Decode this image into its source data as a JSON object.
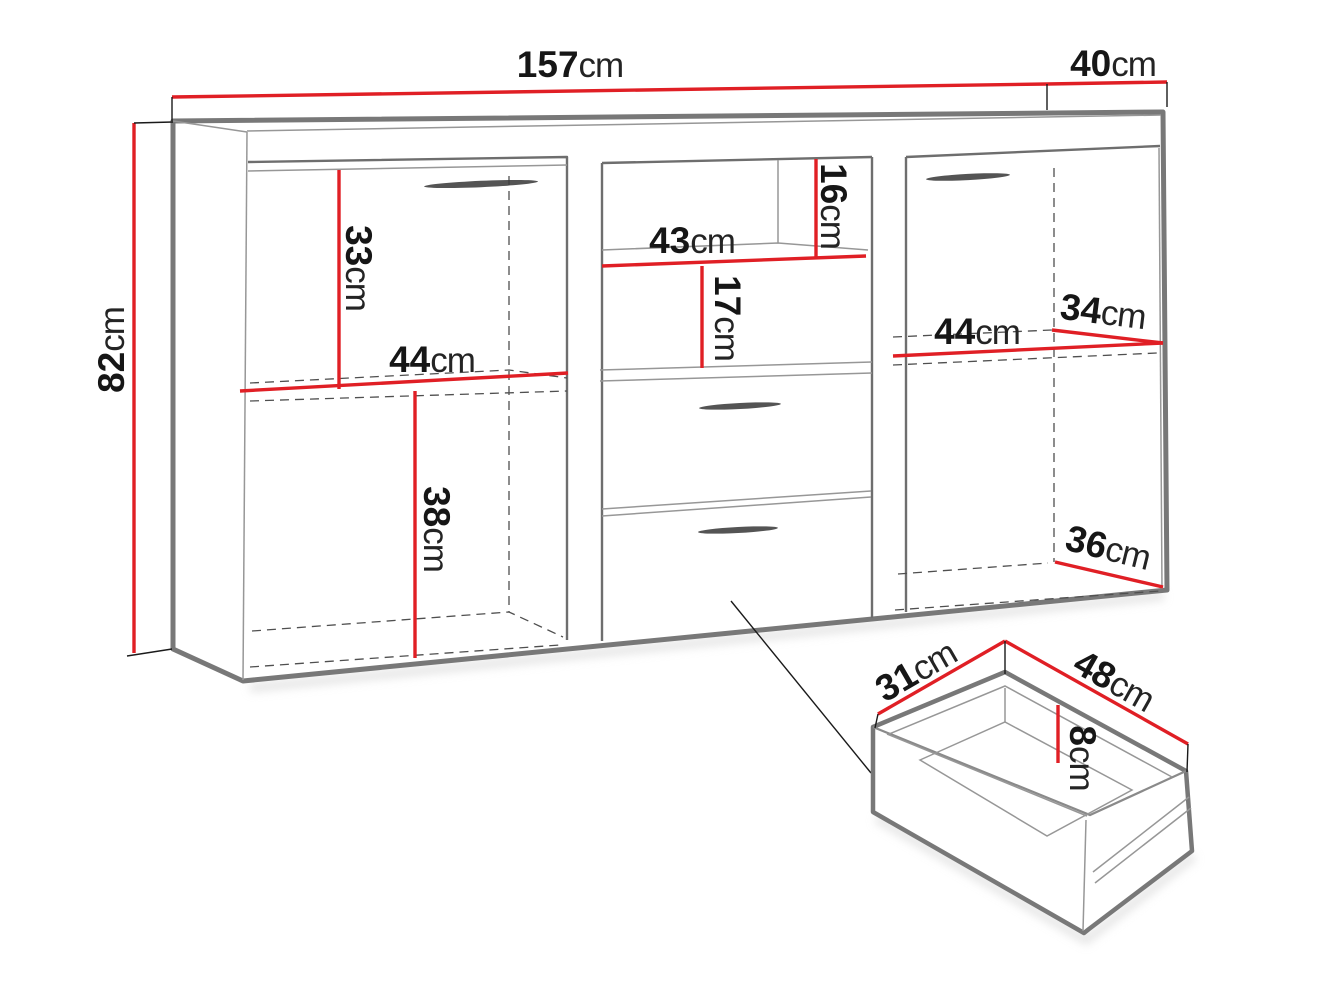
{
  "dimensions": {
    "cabinet_width": {
      "value": "157",
      "unit": "cm"
    },
    "cabinet_depth": {
      "value": "40",
      "unit": "cm"
    },
    "cabinet_height": {
      "value": "82",
      "unit": "cm"
    },
    "left_upper_height": {
      "value": "33",
      "unit": "cm"
    },
    "left_width": {
      "value": "44",
      "unit": "cm"
    },
    "left_lower_height": {
      "value": "38",
      "unit": "cm"
    },
    "middle_shelf_width": {
      "value": "43",
      "unit": "cm"
    },
    "middle_top_gap_height": {
      "value": "16",
      "unit": "cm"
    },
    "middle_shelf_gap_height": {
      "value": "17",
      "unit": "cm"
    },
    "right_width": {
      "value": "44",
      "unit": "cm"
    },
    "right_shelf_depth": {
      "value": "34",
      "unit": "cm"
    },
    "right_bottom_depth": {
      "value": "36",
      "unit": "cm"
    },
    "drawer_depth": {
      "value": "31",
      "unit": "cm"
    },
    "drawer_width": {
      "value": "48",
      "unit": "cm"
    },
    "drawer_inner_height": {
      "value": "8",
      "unit": "cm"
    }
  },
  "colors": {
    "dimension_line": "#e01f25",
    "cabinet_outline": "#787878",
    "dashed_hidden_edge": "#4f4f4f",
    "label_text": "#161616"
  }
}
